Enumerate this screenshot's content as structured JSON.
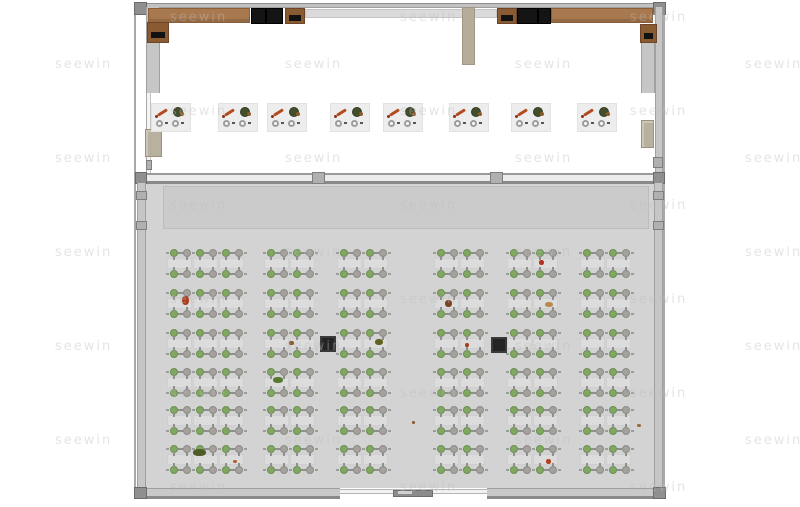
{
  "watermark": {
    "text": "seewin",
    "color": "#bdbdbd"
  },
  "palette": {
    "floor_lower": "#d3d3d3",
    "floor_upper": "#ffffff",
    "wall_gray": "#c6c6c6",
    "counter_brown": "#a8794e",
    "appliance_black": "#141414",
    "partition_tan": "#b5ac99",
    "seat_green": "#82a763",
    "seat_gray": "#a3a29c",
    "table_gray": "#dcdcdc",
    "pillar_dark": "#242424",
    "station_bg": "#ededed"
  },
  "floorplan": {
    "upper_hall": {
      "equipment": [
        {
          "kind": "counter",
          "name": "counter-top-left",
          "x": 148,
          "y": 8,
          "w": 102,
          "h": 15
        },
        {
          "kind": "appliance",
          "name": "appliance-black",
          "x": 251,
          "y": 8,
          "w": 15,
          "h": 16
        },
        {
          "kind": "appliance",
          "name": "appliance-black",
          "x": 266,
          "y": 8,
          "w": 17,
          "h": 16
        },
        {
          "kind": "prep",
          "name": "prep-table-brown",
          "x": 285,
          "y": 8,
          "w": 20,
          "h": 16
        },
        {
          "kind": "counter-light",
          "name": "service-counter-middle",
          "x": 305,
          "y": 9,
          "w": 192,
          "h": 9
        },
        {
          "kind": "prep",
          "name": "prep-table-brown",
          "x": 497,
          "y": 8,
          "w": 20,
          "h": 16
        },
        {
          "kind": "appliance",
          "name": "appliance-black",
          "x": 517,
          "y": 8,
          "w": 21,
          "h": 16
        },
        {
          "kind": "appliance",
          "name": "appliance-black",
          "x": 538,
          "y": 8,
          "w": 13,
          "h": 16
        },
        {
          "kind": "counter",
          "name": "counter-top-right",
          "x": 551,
          "y": 8,
          "w": 102,
          "h": 15
        },
        {
          "kind": "partition",
          "name": "partition-wall-tan",
          "x": 462,
          "y": 7,
          "w": 13,
          "h": 58
        },
        {
          "kind": "prep",
          "name": "wall-box-brown-left",
          "x": 147,
          "y": 22,
          "w": 22,
          "h": 21
        },
        {
          "kind": "cabinet",
          "name": "wall-cabinet-tan-left",
          "x": 145,
          "y": 129,
          "w": 17,
          "h": 28
        },
        {
          "kind": "prep",
          "name": "wall-box-brown-right",
          "x": 640,
          "y": 24,
          "w": 17,
          "h": 19
        },
        {
          "kind": "cabinet",
          "name": "wall-cabinet-tan-right",
          "x": 641,
          "y": 120,
          "w": 13,
          "h": 28
        }
      ],
      "stations": {
        "y": 104,
        "w": 38,
        "h": 27,
        "xs": [
          152,
          219,
          268,
          331,
          384,
          450,
          512,
          578
        ]
      }
    },
    "lower_hall": {
      "group_top_y": [
        249,
        289,
        329,
        368,
        406,
        445
      ],
      "row_gap": 21,
      "pair_pitch": 26,
      "blocks": [
        {
          "x": 170,
          "pairs": 3
        },
        {
          "x": 267,
          "pairs": 2
        },
        {
          "x": 340,
          "pairs": 2
        },
        {
          "x": 437,
          "pairs": 2
        },
        {
          "x": 510,
          "pairs": 2
        },
        {
          "x": 583,
          "pairs": 2
        }
      ],
      "pillars": [
        {
          "x": 320,
          "y": 336,
          "s": 16
        },
        {
          "x": 491,
          "y": 337,
          "s": 16
        }
      ],
      "debris": [
        {
          "x": 182,
          "y": 296,
          "w": 7,
          "h": 9,
          "c": "#a8401e"
        },
        {
          "x": 539,
          "y": 260,
          "w": 5,
          "h": 5,
          "c": "#b5301d"
        },
        {
          "x": 445,
          "y": 300,
          "w": 7,
          "h": 7,
          "c": "#7a4420"
        },
        {
          "x": 545,
          "y": 302,
          "w": 8,
          "h": 5,
          "c": "#b98a4e"
        },
        {
          "x": 289,
          "y": 341,
          "w": 5,
          "h": 4,
          "c": "#8a5a28"
        },
        {
          "x": 375,
          "y": 339,
          "w": 8,
          "h": 6,
          "c": "#606022"
        },
        {
          "x": 465,
          "y": 343,
          "w": 4,
          "h": 4,
          "c": "#a5401f"
        },
        {
          "x": 273,
          "y": 377,
          "w": 10,
          "h": 6,
          "c": "#567a30"
        },
        {
          "x": 412,
          "y": 421,
          "w": 3,
          "h": 3,
          "c": "#8a5a28"
        },
        {
          "x": 637,
          "y": 424,
          "w": 4,
          "h": 3,
          "c": "#9a6a2e"
        },
        {
          "x": 193,
          "y": 449,
          "w": 13,
          "h": 7,
          "c": "#4f5c28"
        },
        {
          "x": 233,
          "y": 460,
          "w": 4,
          "h": 3,
          "c": "#b06030"
        },
        {
          "x": 546,
          "y": 459,
          "w": 5,
          "h": 5,
          "c": "#b5401d"
        }
      ]
    }
  }
}
